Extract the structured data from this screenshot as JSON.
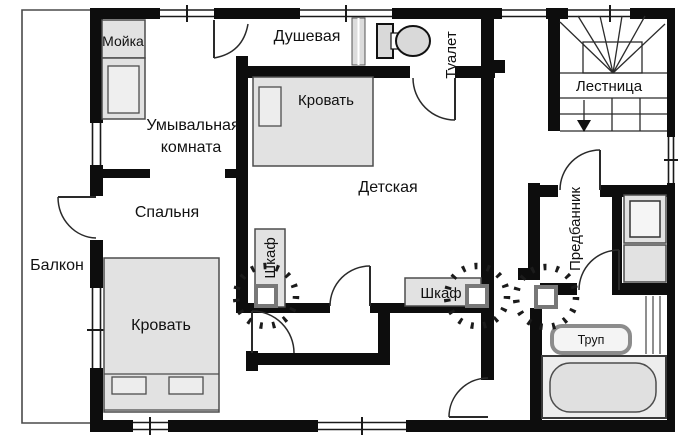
{
  "rooms": {
    "balcony": {
      "label": "Балкон"
    },
    "washroom": {
      "line1": "Умывальная",
      "line2": "комната"
    },
    "shower": {
      "label": "Душевая"
    },
    "toilet": {
      "label": "Туалет"
    },
    "staircase": {
      "label": "Лестница"
    },
    "nursery": {
      "label": "Детская"
    },
    "bedroom": {
      "label": "Спальня"
    },
    "vestibule": {
      "label": "Предбанник"
    }
  },
  "furniture": {
    "sink": {
      "label": "Мойка"
    },
    "nursery_bed": {
      "label": "Кровать"
    },
    "bedroom_bed": {
      "label": "Кровать"
    },
    "wardrobe_left": {
      "label": "Шкаф"
    },
    "wardrobe_right": {
      "label": "Шкаф"
    },
    "corpse_mat": {
      "label": "Труп"
    }
  },
  "colors": {
    "walls": "#0d0d0d",
    "furniture_fill": "#e2e2e2",
    "furniture_stroke": "#4d4d4d",
    "device_stroke": "#787878",
    "mat_stroke": "#8c8c8c",
    "background": "#ffffff"
  }
}
